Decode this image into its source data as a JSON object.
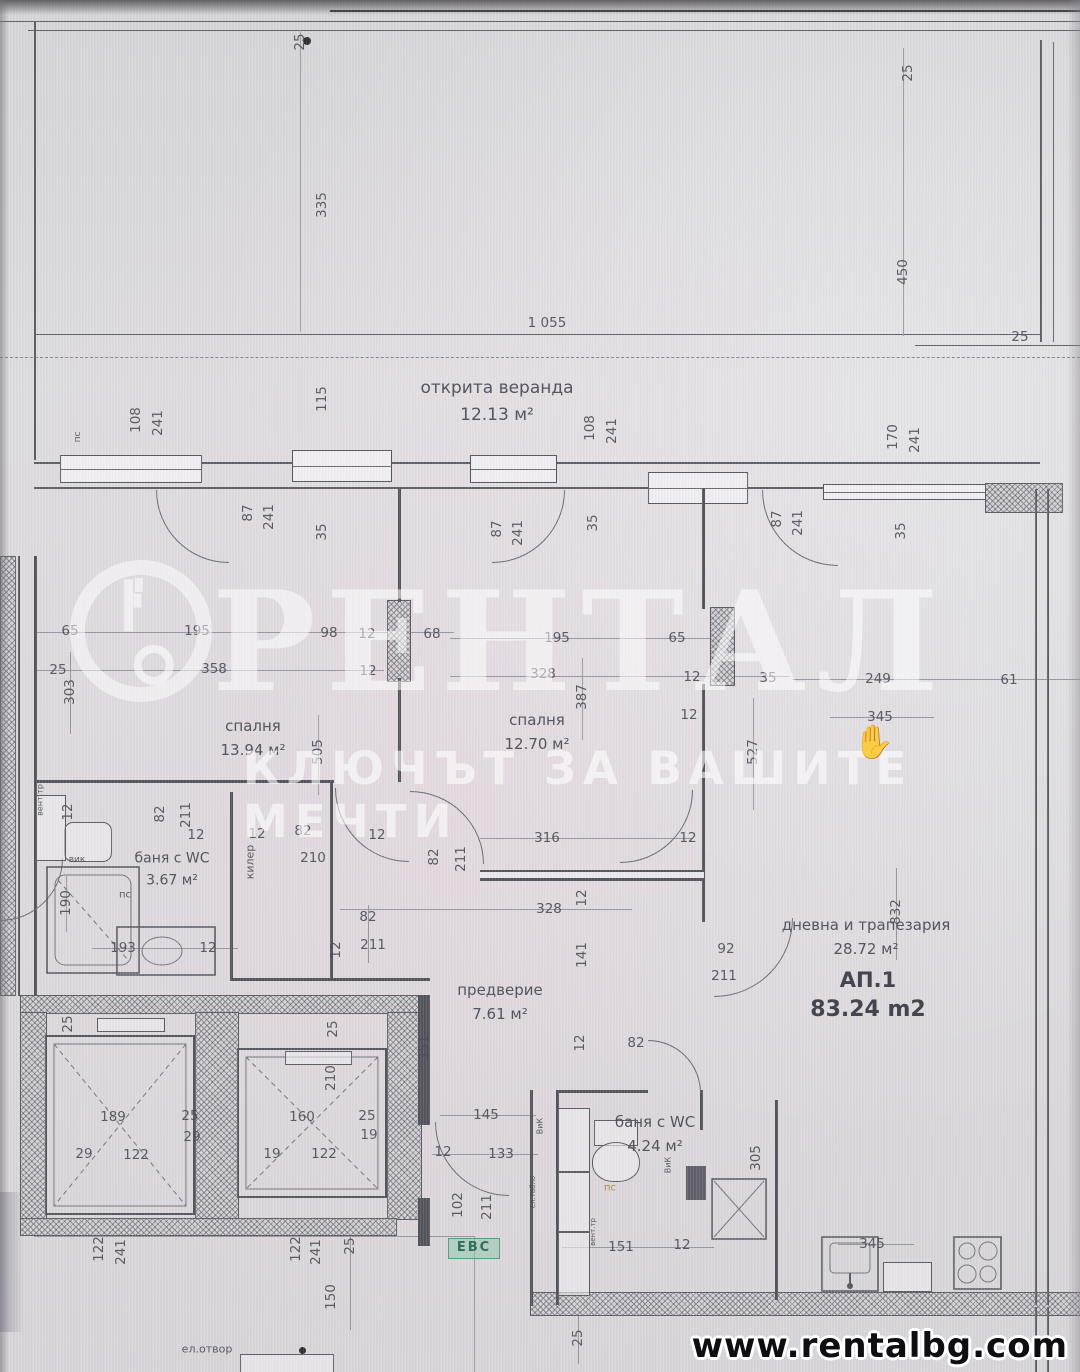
{
  "watermark": {
    "brand": "РЕНТАЛ",
    "tagline": "КЛЮЧЪТ ЗА ВАШИТЕ МЕЧТИ"
  },
  "footer": {
    "website": "www.rentalbg.com"
  },
  "apartment": {
    "label": "АП.1",
    "area": "83.24 m2"
  },
  "badges": {
    "evs": "ЕВС"
  },
  "icons": {
    "hand": "✋"
  },
  "colors": {
    "paper": "#d9d7db",
    "ink": "#53535c",
    "dim_text": "#4d4d57",
    "watermark": "rgba(255,255,255,0.55)",
    "evs_bg": "#92c8b0",
    "evs_text": "#2f6f55",
    "pc_accent": "#b07f35",
    "footer_text": "#0e0e10"
  },
  "rooms": [
    {
      "name": "открита веранда",
      "area": "12.13 м²",
      "x": 497,
      "y": 402,
      "size": 17
    },
    {
      "name": "спалня",
      "area": "13.94 м²",
      "x": 253,
      "y": 738,
      "size": 15
    },
    {
      "name": "спалня",
      "area": "12.70 м²",
      "x": 537,
      "y": 732,
      "size": 15
    },
    {
      "name": "баня с WC",
      "area": "3.67 м²",
      "x": 172,
      "y": 870,
      "size": 14
    },
    {
      "name": "предверие",
      "area": "7.61 м²",
      "x": 500,
      "y": 1002,
      "size": 15
    },
    {
      "name": "дневна и трапезария",
      "area": "28.72 м²",
      "x": 866,
      "y": 937,
      "size": 15
    },
    {
      "name": "баня с WC",
      "area": "4.24 м²",
      "x": 655,
      "y": 1134,
      "size": 15
    }
  ],
  "dim_labels": [
    {
      "t": "25",
      "x": 300,
      "y": 42,
      "r": -90
    },
    {
      "t": "335",
      "x": 322,
      "y": 205,
      "r": -90
    },
    {
      "t": "25",
      "x": 908,
      "y": 73,
      "r": -90
    },
    {
      "t": "450",
      "x": 903,
      "y": 272,
      "r": -90
    },
    {
      "t": "1 055",
      "x": 547,
      "y": 323
    },
    {
      "t": "25",
      "x": 1020,
      "y": 337
    },
    {
      "t": "пс",
      "x": 78,
      "y": 437,
      "r": -90,
      "s": 9
    },
    {
      "t": "108",
      "x": 136,
      "y": 420,
      "r": -90
    },
    {
      "t": "241",
      "x": 158,
      "y": 423,
      "r": -90
    },
    {
      "t": "115",
      "x": 322,
      "y": 399,
      "r": -90
    },
    {
      "t": "108",
      "x": 590,
      "y": 428,
      "r": -90
    },
    {
      "t": "241",
      "x": 612,
      "y": 431,
      "r": -90
    },
    {
      "t": "170",
      "x": 893,
      "y": 437,
      "r": -90
    },
    {
      "t": "241",
      "x": 915,
      "y": 440,
      "r": -90
    },
    {
      "t": "87",
      "x": 248,
      "y": 513,
      "r": -90
    },
    {
      "t": "241",
      "x": 269,
      "y": 517,
      "r": -90
    },
    {
      "t": "35",
      "x": 322,
      "y": 532,
      "r": -90
    },
    {
      "t": "87",
      "x": 497,
      "y": 529,
      "r": -90
    },
    {
      "t": "241",
      "x": 518,
      "y": 533,
      "r": -90
    },
    {
      "t": "35",
      "x": 593,
      "y": 523,
      "r": -90
    },
    {
      "t": "87",
      "x": 777,
      "y": 519,
      "r": -90
    },
    {
      "t": "241",
      "x": 798,
      "y": 523,
      "r": -90
    },
    {
      "t": "35",
      "x": 901,
      "y": 531,
      "r": -90
    },
    {
      "t": "65",
      "x": 70,
      "y": 631
    },
    {
      "t": "195",
      "x": 197,
      "y": 631
    },
    {
      "t": "98",
      "x": 329,
      "y": 633
    },
    {
      "t": "12",
      "x": 367,
      "y": 634
    },
    {
      "t": "68",
      "x": 432,
      "y": 634
    },
    {
      "t": "25",
      "x": 58,
      "y": 670
    },
    {
      "t": "358",
      "x": 214,
      "y": 669
    },
    {
      "t": "12",
      "x": 368,
      "y": 671
    },
    {
      "t": "303",
      "x": 70,
      "y": 692,
      "r": -90
    },
    {
      "t": "195",
      "x": 557,
      "y": 638
    },
    {
      "t": "65",
      "x": 677,
      "y": 638
    },
    {
      "t": "328",
      "x": 543,
      "y": 674
    },
    {
      "t": "387",
      "x": 582,
      "y": 697,
      "r": -90
    },
    {
      "t": "12",
      "x": 692,
      "y": 677
    },
    {
      "t": "35",
      "x": 768,
      "y": 678
    },
    {
      "t": "12",
      "x": 689,
      "y": 715
    },
    {
      "t": "249",
      "x": 878,
      "y": 679
    },
    {
      "t": "61",
      "x": 1009,
      "y": 680
    },
    {
      "t": "345",
      "x": 880,
      "y": 717
    },
    {
      "t": "505",
      "x": 318,
      "y": 752,
      "r": -90
    },
    {
      "t": "527",
      "x": 753,
      "y": 752,
      "r": -90
    },
    {
      "t": "вент.тр",
      "x": 40,
      "y": 800,
      "r": -90,
      "s": 8
    },
    {
      "t": "12",
      "x": 68,
      "y": 812,
      "r": -90
    },
    {
      "t": "82",
      "x": 160,
      "y": 814,
      "r": -90
    },
    {
      "t": "211",
      "x": 186,
      "y": 815,
      "r": -90
    },
    {
      "t": "12",
      "x": 196,
      "y": 835
    },
    {
      "t": "12",
      "x": 257,
      "y": 834
    },
    {
      "t": "82",
      "x": 303,
      "y": 831
    },
    {
      "t": "210",
      "x": 313,
      "y": 858
    },
    {
      "t": "килер",
      "x": 250,
      "y": 862,
      "r": -90,
      "s": 11
    },
    {
      "t": "вик",
      "x": 77,
      "y": 860,
      "s": 9
    },
    {
      "t": "190",
      "x": 66,
      "y": 903,
      "r": -90
    },
    {
      "t": "193",
      "x": 123,
      "y": 948
    },
    {
      "t": "12",
      "x": 208,
      "y": 948
    },
    {
      "t": "пс",
      "x": 125,
      "y": 895,
      "s": 10
    },
    {
      "t": "12",
      "x": 377,
      "y": 835
    },
    {
      "t": "82",
      "x": 434,
      "y": 857,
      "r": -90
    },
    {
      "t": "211",
      "x": 461,
      "y": 859,
      "r": -90
    },
    {
      "t": "316",
      "x": 547,
      "y": 838
    },
    {
      "t": "12",
      "x": 688,
      "y": 838
    },
    {
      "t": "328",
      "x": 549,
      "y": 909
    },
    {
      "t": "12",
      "x": 582,
      "y": 898,
      "r": -90
    },
    {
      "t": "82",
      "x": 368,
      "y": 917
    },
    {
      "t": "211",
      "x": 373,
      "y": 945
    },
    {
      "t": "12",
      "x": 336,
      "y": 950,
      "r": -90
    },
    {
      "t": "141",
      "x": 582,
      "y": 955,
      "r": -90
    },
    {
      "t": "92",
      "x": 726,
      "y": 949
    },
    {
      "t": "211",
      "x": 724,
      "y": 976
    },
    {
      "t": "832",
      "x": 896,
      "y": 912,
      "r": -90
    },
    {
      "t": "25",
      "x": 68,
      "y": 1024,
      "r": -90
    },
    {
      "t": "189",
      "x": 113,
      "y": 1117
    },
    {
      "t": "25",
      "x": 190,
      "y": 1116
    },
    {
      "t": "29",
      "x": 192,
      "y": 1137
    },
    {
      "t": "29",
      "x": 84,
      "y": 1154
    },
    {
      "t": "122",
      "x": 136,
      "y": 1155
    },
    {
      "t": "25",
      "x": 333,
      "y": 1029,
      "r": -90
    },
    {
      "t": "210",
      "x": 331,
      "y": 1078,
      "r": -90
    },
    {
      "t": "160",
      "x": 302,
      "y": 1117
    },
    {
      "t": "25",
      "x": 367,
      "y": 1116
    },
    {
      "t": "19",
      "x": 369,
      "y": 1135
    },
    {
      "t": "19",
      "x": 272,
      "y": 1154
    },
    {
      "t": "122",
      "x": 324,
      "y": 1154
    },
    {
      "t": "351",
      "x": 424,
      "y": 1048,
      "r": -90
    },
    {
      "t": "145",
      "x": 486,
      "y": 1115
    },
    {
      "t": "12",
      "x": 443,
      "y": 1152
    },
    {
      "t": "133",
      "x": 501,
      "y": 1154
    },
    {
      "t": "102",
      "x": 458,
      "y": 1205,
      "r": -90
    },
    {
      "t": "211",
      "x": 487,
      "y": 1207,
      "r": -90
    },
    {
      "t": "12",
      "x": 580,
      "y": 1043,
      "r": -90
    },
    {
      "t": "82",
      "x": 636,
      "y": 1043
    },
    {
      "t": "ВиК",
      "x": 540,
      "y": 1126,
      "r": -90,
      "s": 8
    },
    {
      "t": "пс",
      "x": 610,
      "y": 1188,
      "s": 10,
      "c": "#b07f35"
    },
    {
      "t": "ел.табло",
      "x": 533,
      "y": 1192,
      "r": -90,
      "s": 7
    },
    {
      "t": "вент.тр",
      "x": 593,
      "y": 1232,
      "r": -90,
      "s": 7
    },
    {
      "t": "ВиК",
      "x": 668,
      "y": 1165,
      "r": -90,
      "s": 8
    },
    {
      "t": "305",
      "x": 756,
      "y": 1158,
      "r": -90
    },
    {
      "t": "151",
      "x": 621,
      "y": 1247
    },
    {
      "t": "12",
      "x": 682,
      "y": 1245
    },
    {
      "t": "345",
      "x": 872,
      "y": 1244
    },
    {
      "t": "122",
      "x": 99,
      "y": 1249,
      "r": -90
    },
    {
      "t": "241",
      "x": 121,
      "y": 1252,
      "r": -90
    },
    {
      "t": "122",
      "x": 296,
      "y": 1249,
      "r": -90
    },
    {
      "t": "241",
      "x": 316,
      "y": 1252,
      "r": -90
    },
    {
      "t": "25",
      "x": 350,
      "y": 1246,
      "r": -90
    },
    {
      "t": "150",
      "x": 331,
      "y": 1297,
      "r": -90
    },
    {
      "t": "25",
      "x": 578,
      "y": 1338,
      "r": -90
    },
    {
      "t": "ел.отвор",
      "x": 207,
      "y": 1349,
      "s": 11
    }
  ]
}
